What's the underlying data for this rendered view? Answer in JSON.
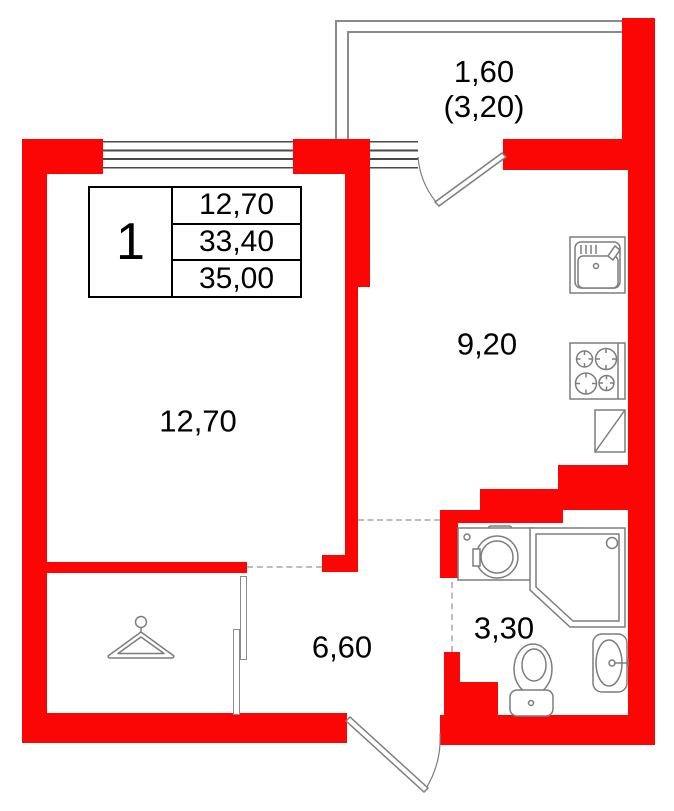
{
  "unit": {
    "number": "1"
  },
  "info_table": {
    "rows": [
      "12,70",
      "33,40",
      "35,00"
    ]
  },
  "labels": {
    "balcony_line1": "1,60",
    "balcony_line2": "(3,20)",
    "kitchen": "9,20",
    "living_room": "12,70",
    "hallway": "6,60",
    "bathroom": "3,30"
  },
  "colors": {
    "wall_red": "#fb0505",
    "fixture_line": "#7d7d7d",
    "window_line": "#4a4a4a",
    "dashed_line": "#bdbdbd",
    "text": "#000000"
  },
  "icons": [
    "kitchen-sink-icon",
    "stove-icon",
    "fridge-icon",
    "washing-machine-icon",
    "shower-icon",
    "toilet-icon",
    "bathroom-sink-icon",
    "hanger-icon",
    "balcony-door-icon",
    "entrance-door-icon"
  ]
}
